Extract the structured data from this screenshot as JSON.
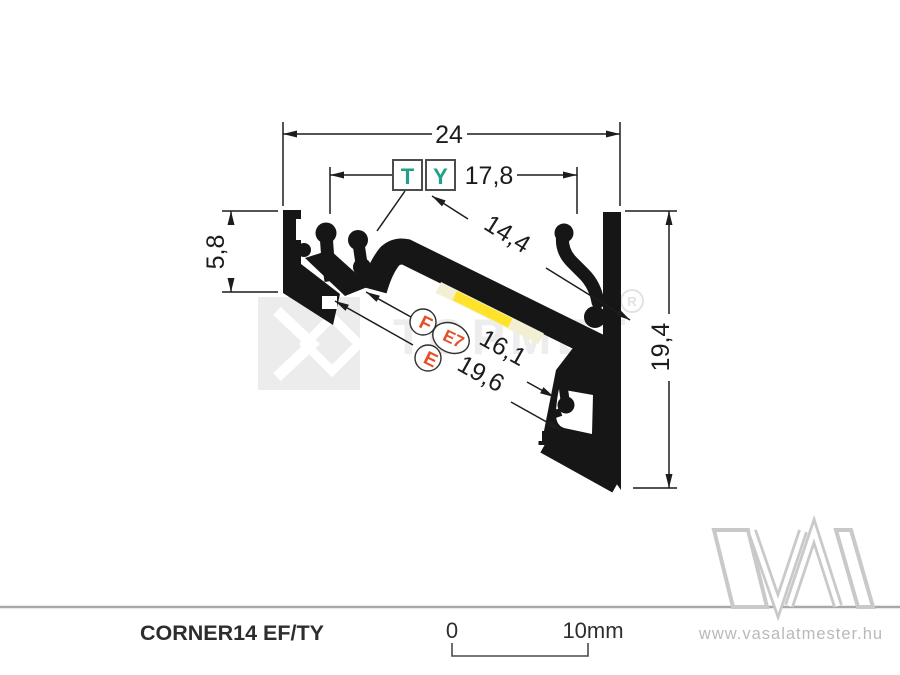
{
  "drawing": {
    "product_name": "CORNER14 EF/TY",
    "dimensions": {
      "overall_width": "24",
      "clip_span": "17,8",
      "channel_face": "14,4",
      "arm_depth": "5,8",
      "overall_height": "19,4",
      "inner_span": "16,1",
      "outer_span": "19,6"
    },
    "markers": {
      "t": "T",
      "y": "Y",
      "f": "F",
      "e7": "E7",
      "e": "E"
    }
  },
  "scale_bar": {
    "start_label": "0",
    "end_label": "10mm"
  },
  "watermark": {
    "brand": "TOPMET",
    "registered": "R"
  },
  "footer": {
    "website": "www.vasalatmester.hu"
  },
  "colors": {
    "marker_teal": "#21a186",
    "marker_orange": "#e4502a",
    "profile_black": "#161616",
    "led_yellow": "#ffe32b",
    "diffuser_cream": "#f3efd3",
    "watermark_gray": "#ececec",
    "divider_gray": "#a8a8a8",
    "dim_line": "#1c1c1c",
    "footer_text_gray": "#b9b9b9"
  }
}
